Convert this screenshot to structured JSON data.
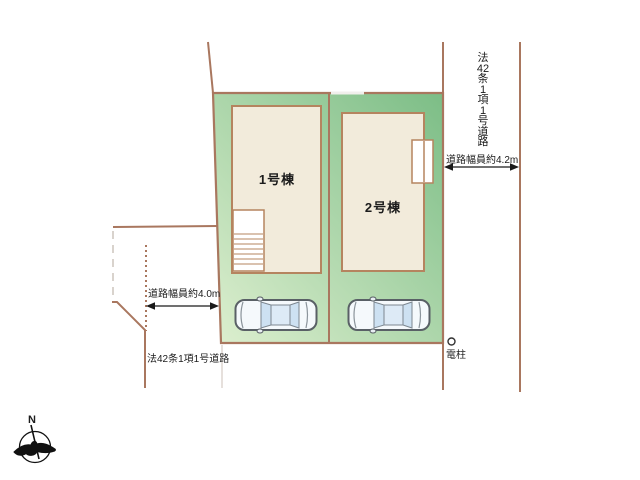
{
  "plot": {
    "building1_label": "1号棟",
    "building2_label": "2号棟"
  },
  "right_road": {
    "name": "法42条1項1号道路",
    "name_chars": [
      "法",
      "42",
      "条",
      "1",
      "項",
      "1",
      "号",
      "道",
      "路"
    ],
    "width_label": "道路幅員約4.2m"
  },
  "left_road": {
    "name": "法42条1項1号道路",
    "width_label": "道路幅員約4.0m"
  },
  "utility_pole": {
    "label": "電柱"
  },
  "compass": {
    "label": "N"
  },
  "colors": {
    "boundary_line": "#a9775f",
    "plot_green_dark": "#7cbd86",
    "plot_green_light": "#ddefcf",
    "building_fill": "#f2ebdb",
    "building_border": "#b5845f",
    "car_glass": "#cde1f2",
    "annotation_text": "#1c1c1c"
  }
}
